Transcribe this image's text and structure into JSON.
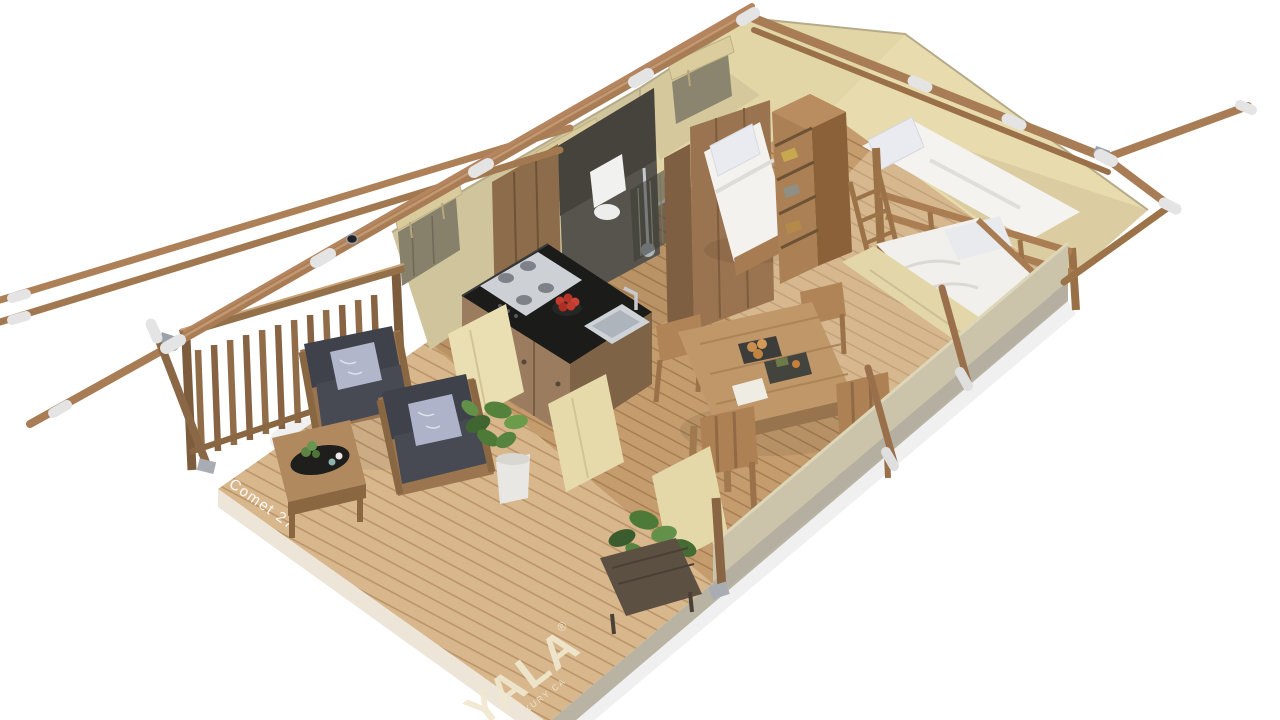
{
  "labels": {
    "model": "Comet 27",
    "brand": "YALA",
    "brand_mark": "®",
    "tagline": "LUXURY CA"
  },
  "palette": {
    "background": "#ffffff",
    "deck_wood": "#d8b78d",
    "deck_gap": "#bb9468",
    "interior_wood": "#c59c6e",
    "interior_gap": "#a57e52",
    "deck_side_light": "#ece5d8",
    "deck_side_gray": "#b8b3a3",
    "canvas_lit": "#e6d9a9",
    "canvas_shaded": "#cfc49b",
    "canvas_end": "#e8dbad",
    "canvas_outer": "#cbc4ab",
    "frame_wood": "#a87c55",
    "rope_lashing": "#e4e4e4",
    "dark_wall": "#56544c",
    "furniture_wood": "#9b7550",
    "cushion_dark": "#42454c",
    "pillow_accent": "#aeb3c9",
    "counter_black": "#1b1b1a",
    "steel": "#cdd1d6",
    "bedding_white": "#f3f2ee",
    "foliage_green": "#53803a",
    "fruit_red": "#c13b2e",
    "text_cream": "#f0e8d0",
    "text_white": "#ffffff"
  },
  "scene": {
    "type": "isometric-cutaway-render",
    "subject": "safari-glamping-tent-floorplan",
    "rooms": [
      "porch-lounge",
      "kitchen",
      "bathroom",
      "dining-area",
      "bedroom",
      "bunk-room"
    ],
    "objects": [
      "a-frame-poles",
      "rope-lashings",
      "porch-railing",
      "armchairs",
      "coffee-table",
      "potted-plants",
      "kitchen-counter",
      "gas-hob",
      "sink",
      "fruit-bowl",
      "toilet",
      "shower",
      "dining-table",
      "dining-chairs",
      "bed",
      "bookshelf",
      "bunk-bed",
      "single-bed",
      "planter-box",
      "canvas-walls",
      "rolled-window-flaps",
      "wood-deck"
    ]
  }
}
